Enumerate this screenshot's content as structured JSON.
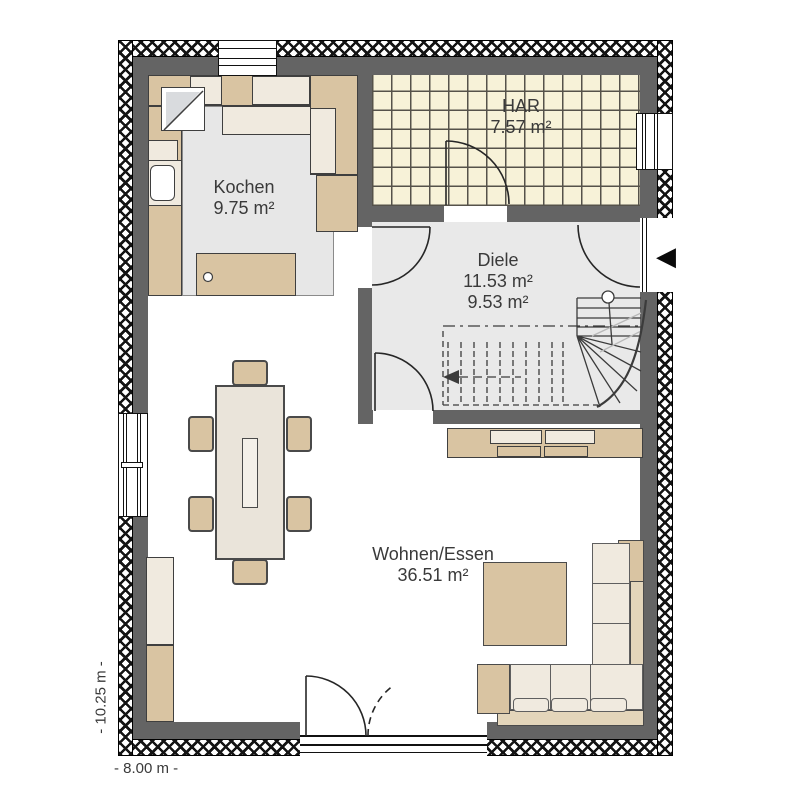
{
  "title": "Erdgeschoss Grundriss (ground floor plan)",
  "rooms": {
    "kochen": {
      "name": "Kochen",
      "area": "9.75 m²"
    },
    "har": {
      "name": "HAR",
      "area": "7.57 m²"
    },
    "diele": {
      "name": "Diele",
      "area1": "11.53 m²",
      "area2": "9.53 m²"
    },
    "wohnen": {
      "name": "Wohnen/Essen",
      "area": "36.51 m²"
    }
  },
  "dimensions": {
    "width_label": "- 8.00 m -",
    "height_label": "- 10.25 m -"
  },
  "icons": {
    "entrance_arrow": "◀"
  },
  "colors": {
    "wall": "#646464",
    "hatch_line": "#141414",
    "floor_gray": "#e9e9e9",
    "kitchen_floor": "#e7e7e7",
    "tile": "#f7f2d8",
    "grout": "#55524a",
    "furniture_tan": "#d9c4a2",
    "furniture_cream": "#f0eadf",
    "outline": "#3f3f3f",
    "text": "#3a3a3a"
  }
}
